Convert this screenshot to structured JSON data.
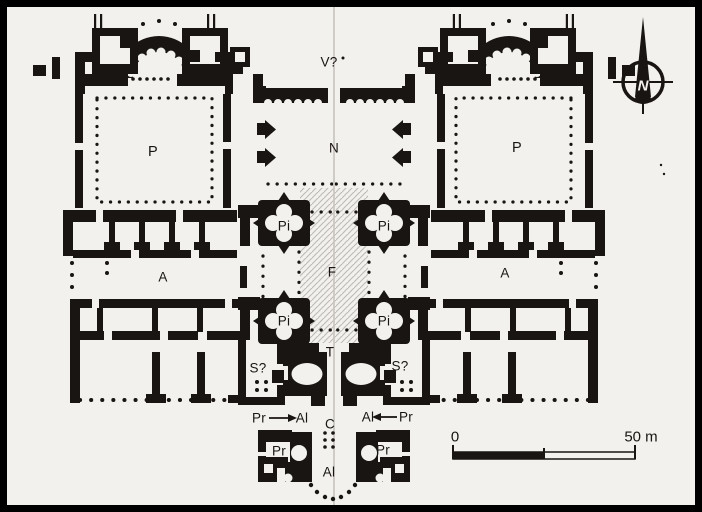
{
  "figure": {
    "kind": "scanned architectural floor plan of a symmetrical twin-courtyard complex",
    "colors": {
      "paper": "#f2f1ee",
      "ink": "#181512",
      "frame": "#000000",
      "hatch": "#bdbab3",
      "fold_line": "#c9c6c0"
    }
  },
  "labels": {
    "v_area": "V?",
    "narthex": "N",
    "peristyle_left": "P",
    "peristyle_right": "P",
    "pier_nw": "Pi",
    "pier_ne": "Pi",
    "pier_sw": "Pi",
    "pier_se": "Pi",
    "f_area": "F",
    "atrium_left": "A",
    "atrium_right": "A",
    "t_area": "T",
    "s_left": "S?",
    "s_right": "S?",
    "arrow_left_from": "Pr",
    "arrow_left_to": "Al",
    "arrow_right_to": "Al",
    "arrow_right_from": "Pr",
    "c_area": "C",
    "chapel_left": "Pr",
    "chapel_right": "Pr",
    "al_bottom": "Al"
  },
  "compass": {
    "north_label": "N"
  },
  "scale_bar": {
    "start_label": "0",
    "end_label": "50 m"
  }
}
